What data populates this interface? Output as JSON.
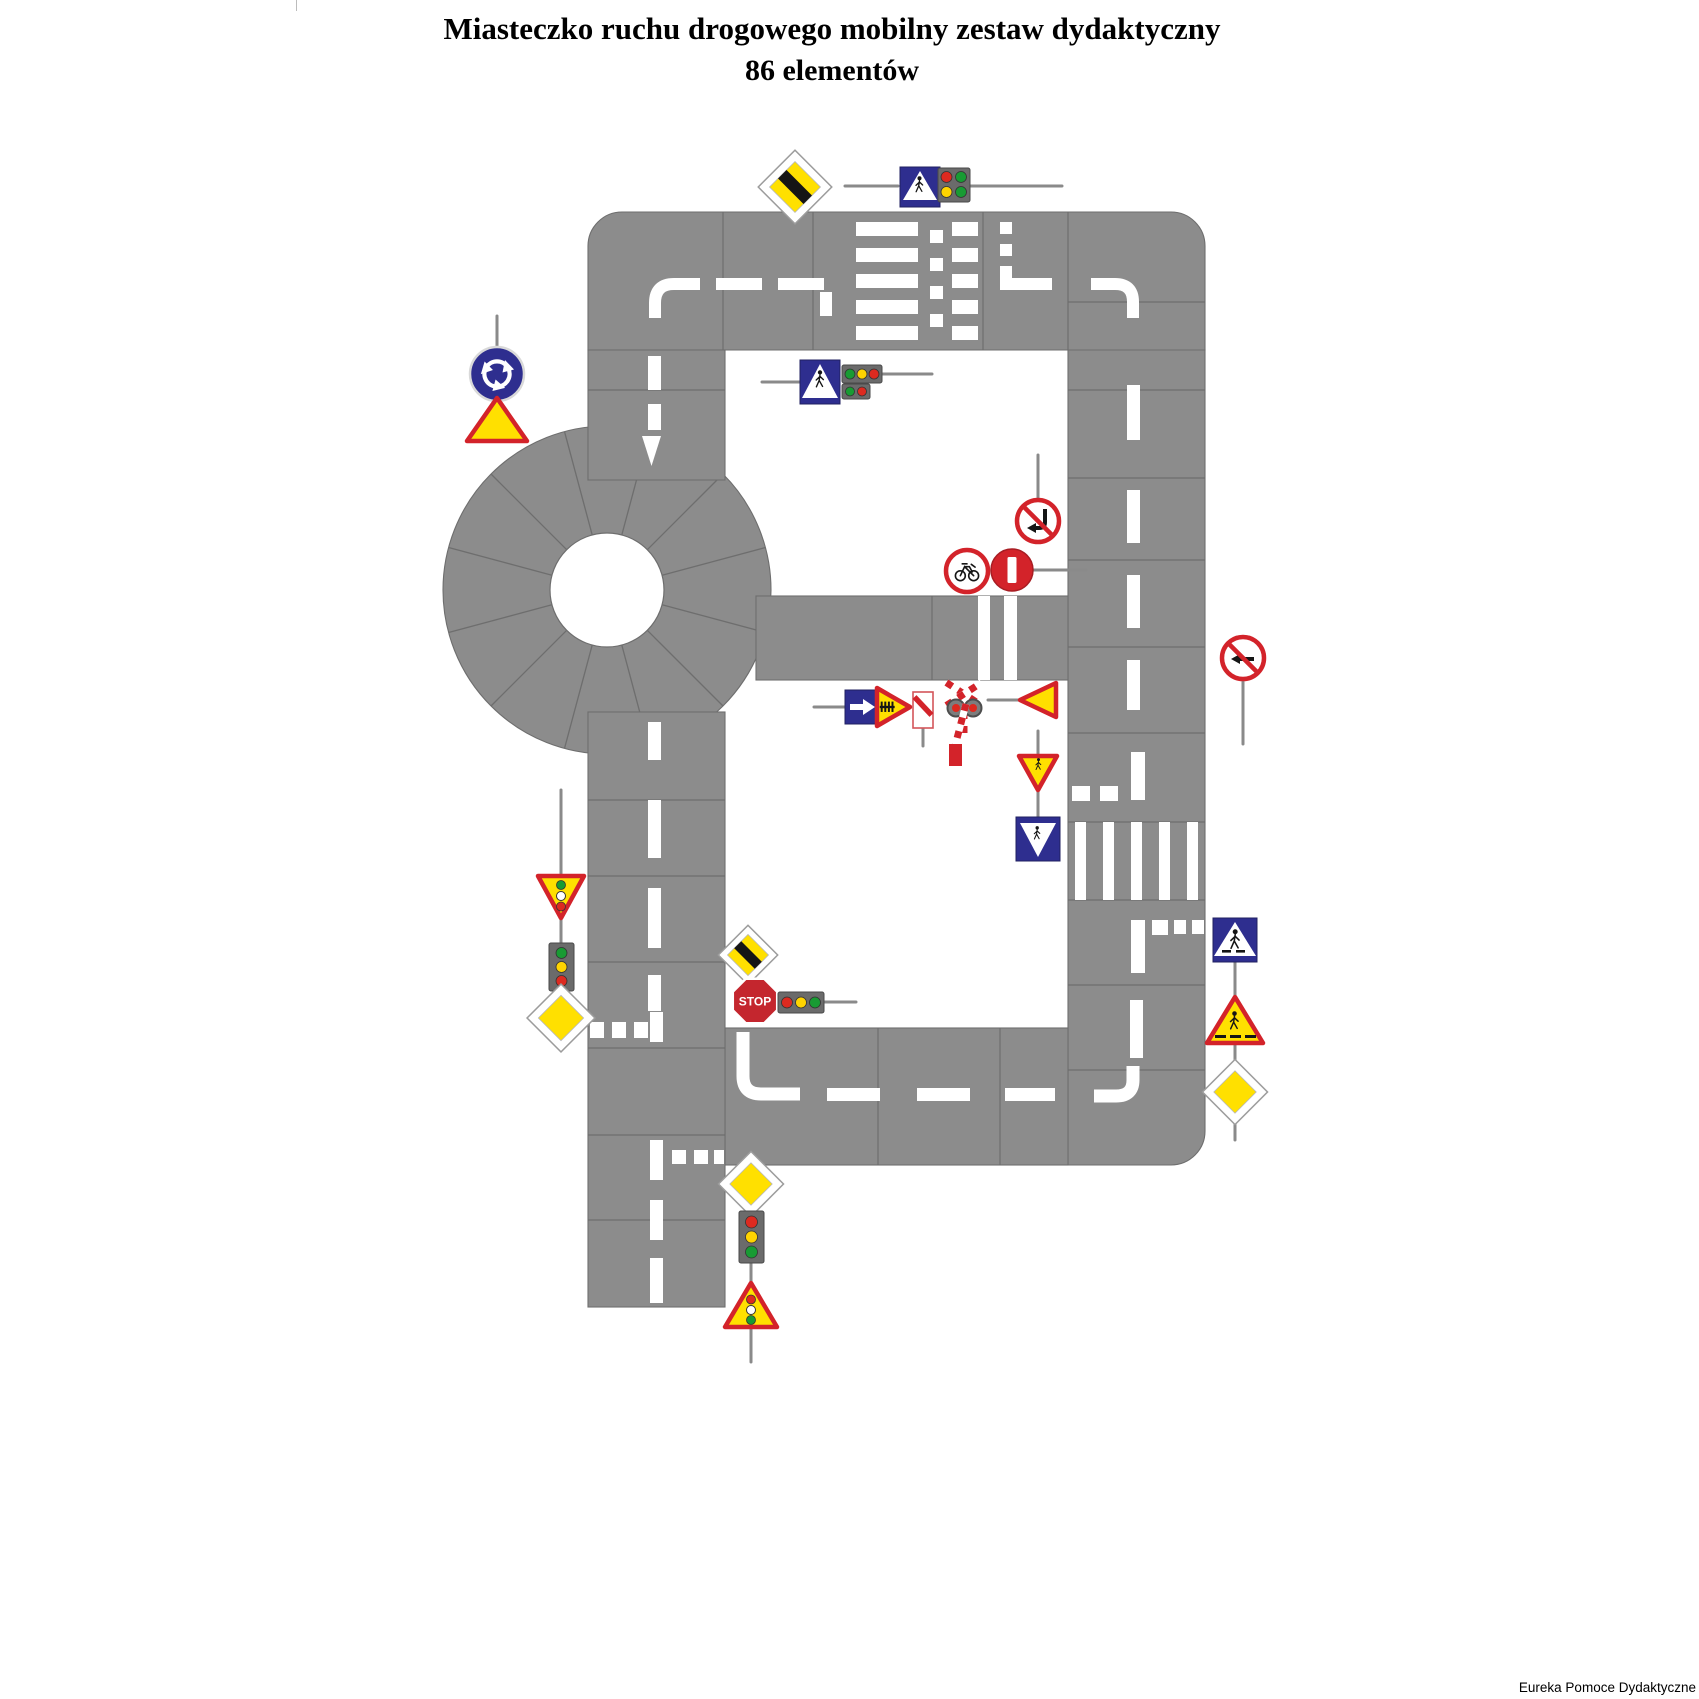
{
  "title": {
    "line1": "Miasteczko ruchu drogowego mobilny zestaw dydaktyczny",
    "line2": "86 elementów"
  },
  "footer": {
    "credit": "Eureka Pomoce Dydaktyczne"
  },
  "stop_sign": {
    "label": "STOP"
  },
  "colors": {
    "road": "#8C8C8C",
    "tile_line": "#6E6E6E",
    "marking": "#FFFFFF",
    "sign_blue": "#2E2E8F",
    "sign_yellow": "#FFE000",
    "sign_red": "#D3232A",
    "stop_red": "#C4262E",
    "light_red": "#DD2A20",
    "light_yellow": "#FFD400",
    "light_green": "#189B33",
    "pole": "#8A8A8A",
    "text": "#000000"
  },
  "traffic_lights": {
    "top_horizontal_bulbs": [
      "red",
      "green",
      "yellow",
      "green"
    ],
    "inner_horizontal_row1": [
      "green",
      "yellow",
      "red"
    ],
    "inner_horizontal_row2": [
      "green",
      "red"
    ],
    "left_vertical_bulbs": [
      "green",
      "yellow",
      "red"
    ],
    "stop_horizontal_bulbs": [
      "red",
      "yellow",
      "green"
    ],
    "bottom_vertical_bulbs": [
      "red",
      "yellow",
      "green"
    ]
  },
  "signs": [
    {
      "id": "end-of-priority-diamond-top",
      "name": "end of priority road (yellow diamond, black band)"
    },
    {
      "id": "pedestrian-crossing-sign-top",
      "name": "pedestrian crossing (blue square, white triangle)"
    },
    {
      "id": "traffic-light-horizontal-top",
      "name": "horizontal traffic signal"
    },
    {
      "id": "pedestrian-crossing-sign-inner",
      "name": "pedestrian crossing (blue square, white triangle)"
    },
    {
      "id": "traffic-light-horizontal-inner",
      "name": "horizontal traffic signal, two rows"
    },
    {
      "id": "no-left-turn-inner",
      "name": "no left turn (red circle, crossed arrow)"
    },
    {
      "id": "no-bicycles",
      "name": "no bicycles (red ring, bicycle)"
    },
    {
      "id": "no-entry",
      "name": "no entry (red disc, white bar)"
    },
    {
      "id": "mandatory-right-arrow",
      "name": "mandatory direction right (blue square, white arrow)"
    },
    {
      "id": "railway-crossing-warning-triangle",
      "name": "railway crossing with barriers (triangle, fence)"
    },
    {
      "id": "countdown-marker",
      "name": "crossing countdown marker (white, red stripe)"
    },
    {
      "id": "st-andrews-cross-with-barrier",
      "name": "St. Andrew's cross, red lamps, barrier arm"
    },
    {
      "id": "yield-triangle-left",
      "name": "yield (triangle pointing left)"
    },
    {
      "id": "warning-triangle-down-mid",
      "name": "warning triangle point-down with crossing symbol"
    },
    {
      "id": "crossing-square-sign-mid",
      "name": "blue square with white point-down triangle"
    },
    {
      "id": "no-left-turn-right-side",
      "name": "no left turn (red circle, crossed arrow)"
    },
    {
      "id": "pedestrian-crossing-sign-right",
      "name": "pedestrian crossing D-6 (blue square, walker)"
    },
    {
      "id": "pedestrian-warning-triangle-right",
      "name": "pedestrian crossing warning (yellow triangle, walker)"
    },
    {
      "id": "priority-road-diamond-right",
      "name": "priority road (yellow diamond)"
    },
    {
      "id": "roundabout-sign",
      "name": "roundabout (blue circle, circular arrows)"
    },
    {
      "id": "roundabout-warning-triangle",
      "name": "roundabout warning (yellow triangle)"
    },
    {
      "id": "traffic-signal-warning-down-left",
      "name": "traffic signal warning triangle point-down"
    },
    {
      "id": "traffic-light-vertical-left",
      "name": "vertical traffic signal"
    },
    {
      "id": "priority-road-diamond-left",
      "name": "priority road (yellow diamond)"
    },
    {
      "id": "end-of-priority-diamond-stop",
      "name": "end of priority road (yellow diamond, black band)"
    },
    {
      "id": "stop-sign",
      "name": "STOP octagon"
    },
    {
      "id": "traffic-light-horizontal-stop",
      "name": "horizontal traffic signal"
    },
    {
      "id": "priority-road-diamond-bottom",
      "name": "priority road (yellow diamond)"
    },
    {
      "id": "traffic-light-vertical-bottom",
      "name": "vertical traffic signal"
    },
    {
      "id": "traffic-signal-warning-up-bottom",
      "name": "traffic signal warning triangle point-up"
    }
  ]
}
